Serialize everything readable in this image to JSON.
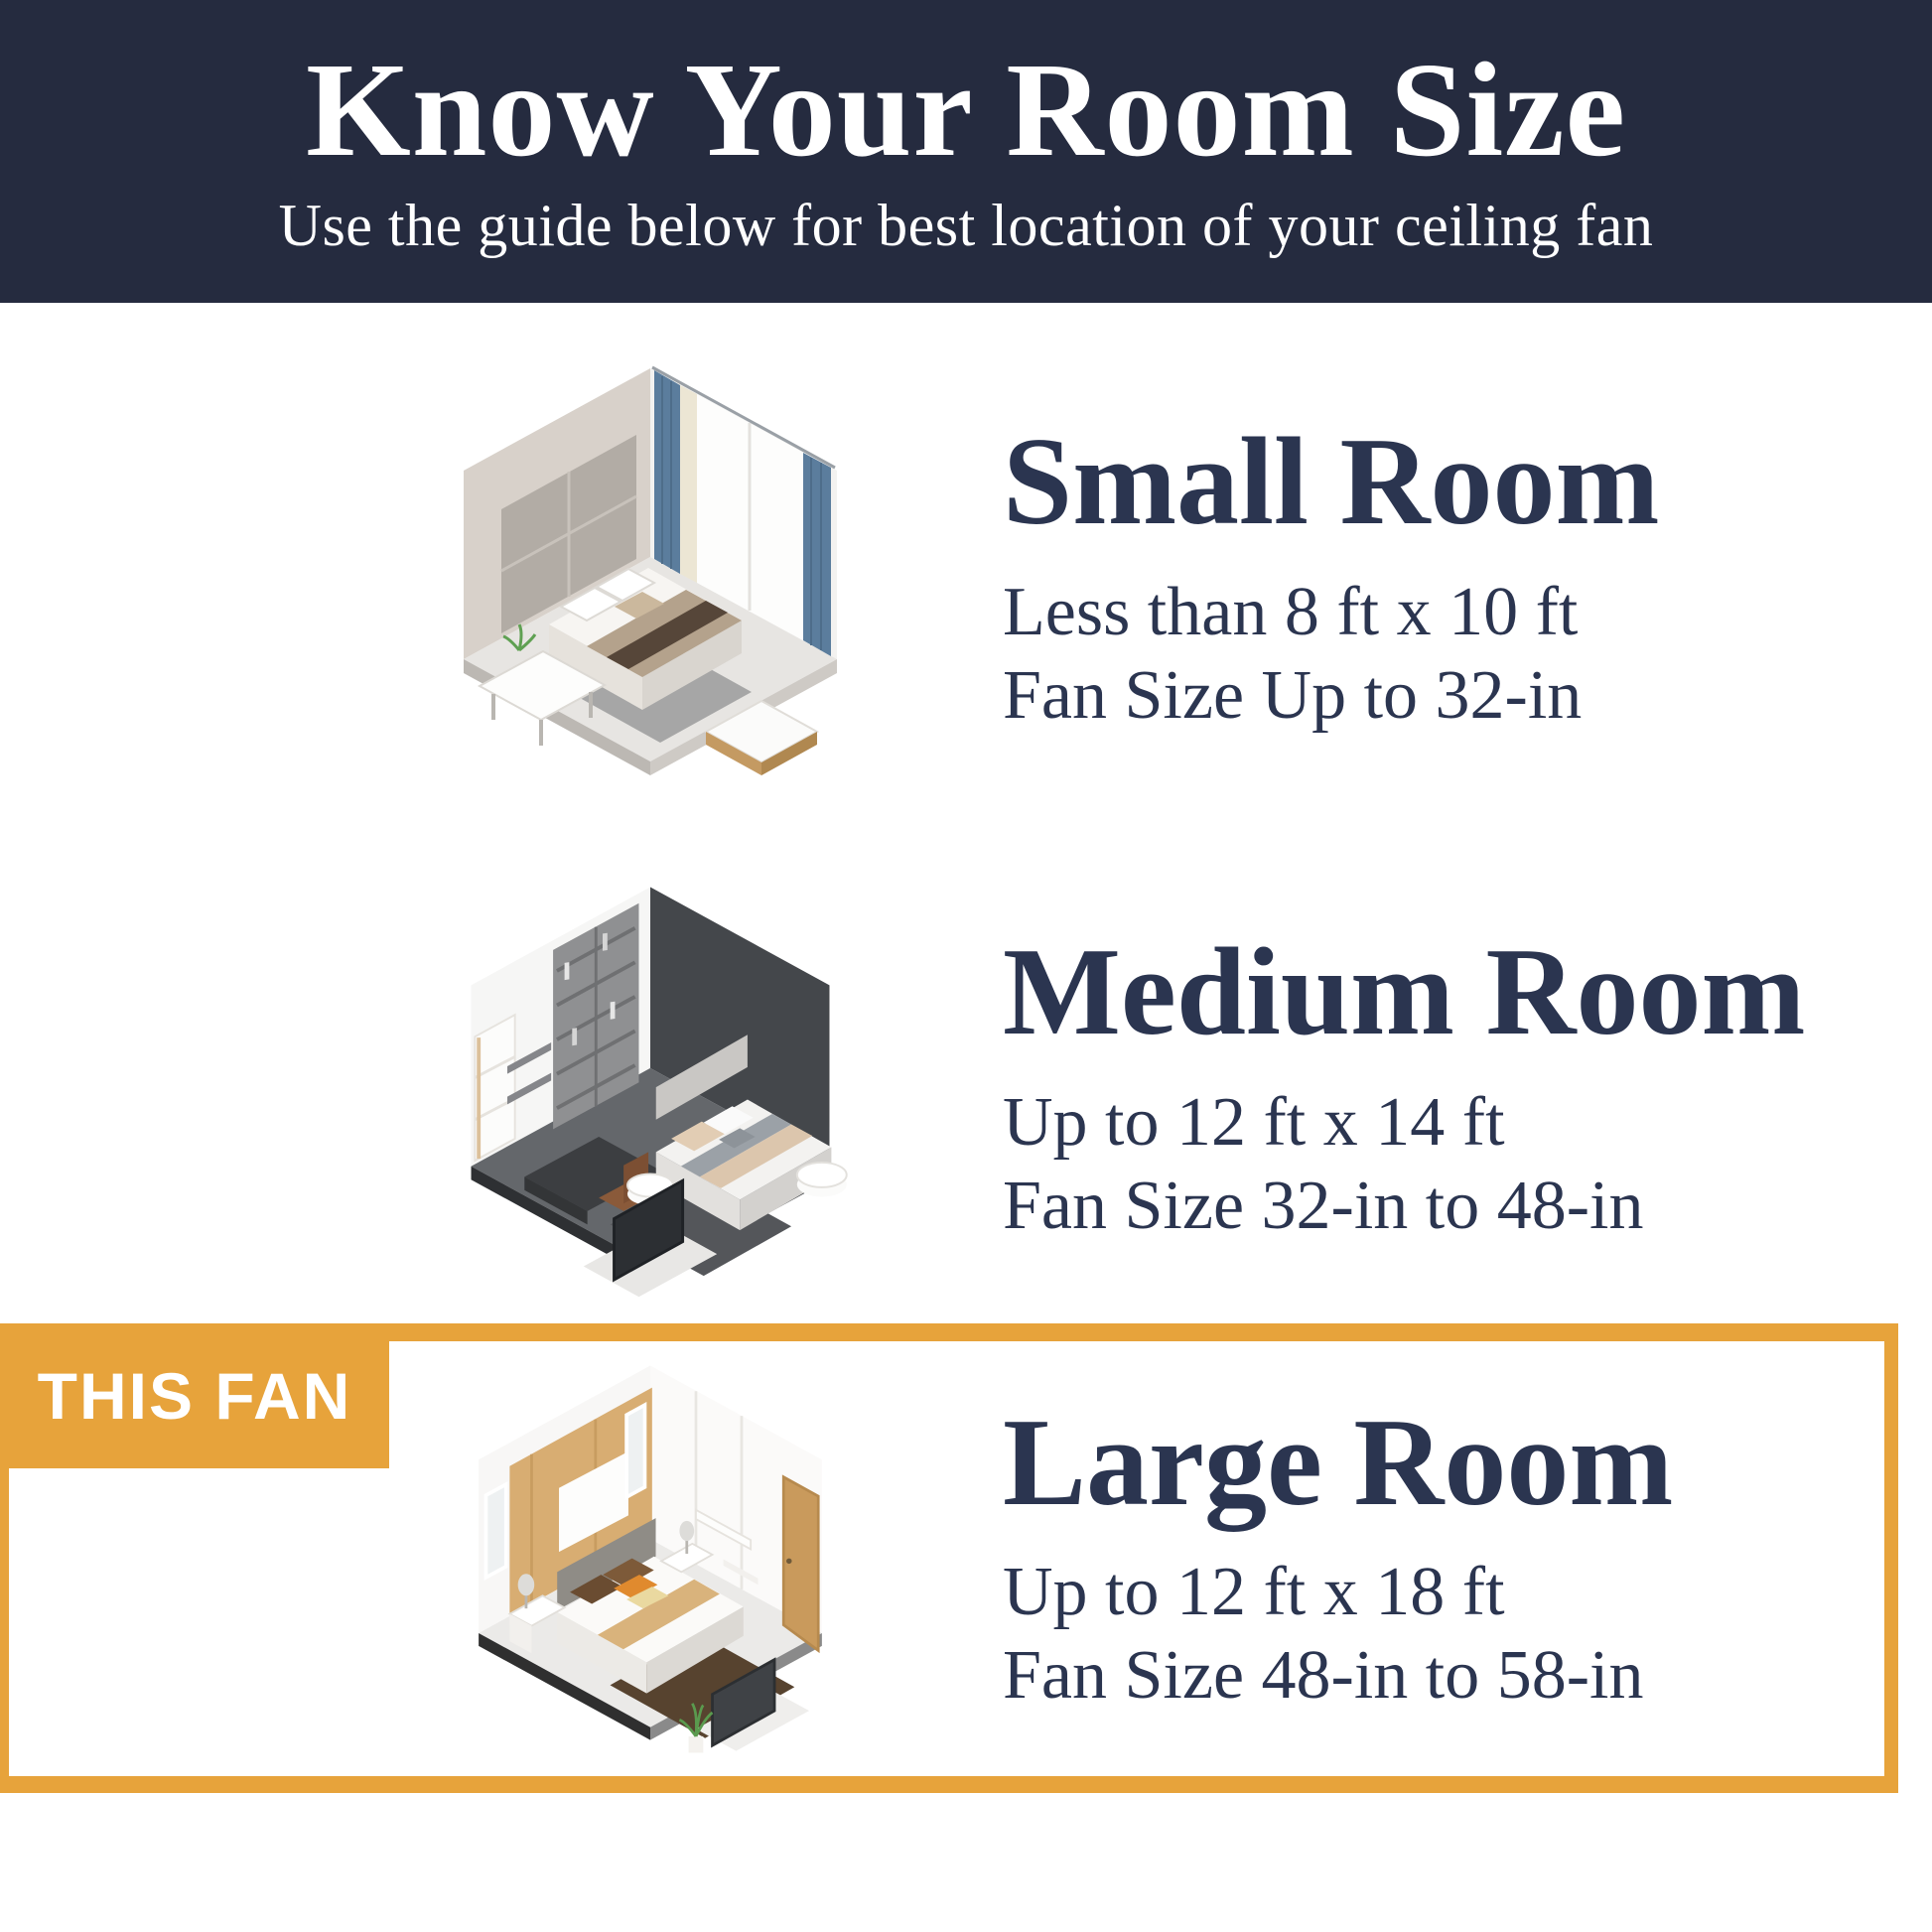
{
  "theme": {
    "navy": "#252b3f",
    "gold": "#e7a33b",
    "text": "#2b3550",
    "white": "#ffffff"
  },
  "header": {
    "title": "Know Your Room Size",
    "subtitle": "Use the guide below for best location of your ceiling fan"
  },
  "highlight": {
    "badge_label": "THIS FAN"
  },
  "rooms": [
    {
      "id": "small",
      "title": "Small Room",
      "dimensions": "Less than 8 ft x 10 ft",
      "fan_size": "Fan Size Up to 32-in",
      "illustration": "isometric-small-bedroom"
    },
    {
      "id": "medium",
      "title": "Medium Room",
      "dimensions": "Up to 12 ft x 14 ft",
      "fan_size": "Fan Size 32-in to 48-in",
      "illustration": "isometric-medium-bedroom"
    },
    {
      "id": "large",
      "title": "Large Room",
      "dimensions": "Up to 12 ft x 18 ft",
      "fan_size": "Fan Size 48-in to 58-in",
      "illustration": "isometric-large-bedroom",
      "highlighted": true
    }
  ]
}
